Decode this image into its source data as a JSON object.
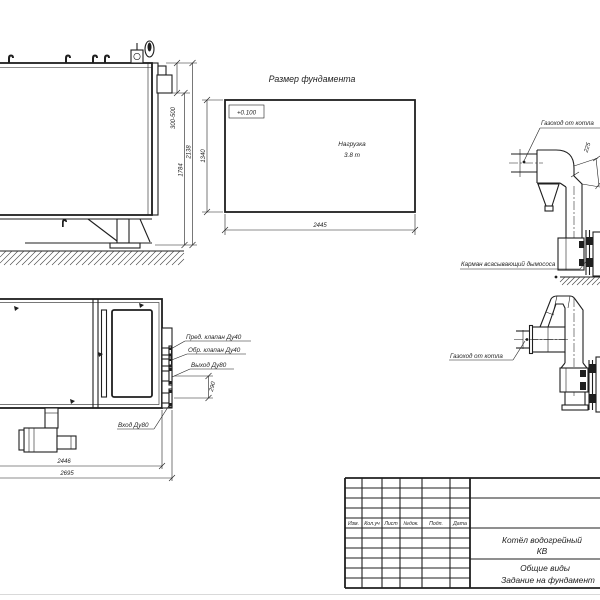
{
  "meta": {
    "paper_color": "#ffffff",
    "ink_color": "#1f1f1f"
  },
  "side_view": {
    "dim_nozzle": "300-500",
    "dim_body": "1784",
    "dim_total": "2138"
  },
  "foundation": {
    "title": "Размер фундамента",
    "elevation": "+0.100",
    "load_line1": "Нагрузка",
    "load_line2": "3.8 т",
    "dim_width": "1340",
    "dim_length": "2445"
  },
  "flue_upper": {
    "duct_label": "Газоход от котла",
    "dim_width": "225",
    "pocket_label": "Карман всасывающий дымососа"
  },
  "flue_lower": {
    "duct_label": "Газоход от котла"
  },
  "plan_view": {
    "safety_valve_label": "Пред. клапан Ду40",
    "check_valve_label": "Обр. клапан Ду40",
    "outlet_label": "Выход Ду80",
    "inlet_label": "Вход Ду80",
    "dim_ports": "290",
    "dim_body": "2446",
    "dim_total": "2695"
  },
  "title_block": {
    "columns": [
      "Изм.",
      "Кол.уч",
      "Лист",
      "№док.",
      "Подп.",
      "Дата"
    ],
    "product_line1": "Котёл водогрейный",
    "product_line2": "КВ",
    "doc_line1": "Общие виды",
    "doc_line2": "Задание на фундамент"
  }
}
